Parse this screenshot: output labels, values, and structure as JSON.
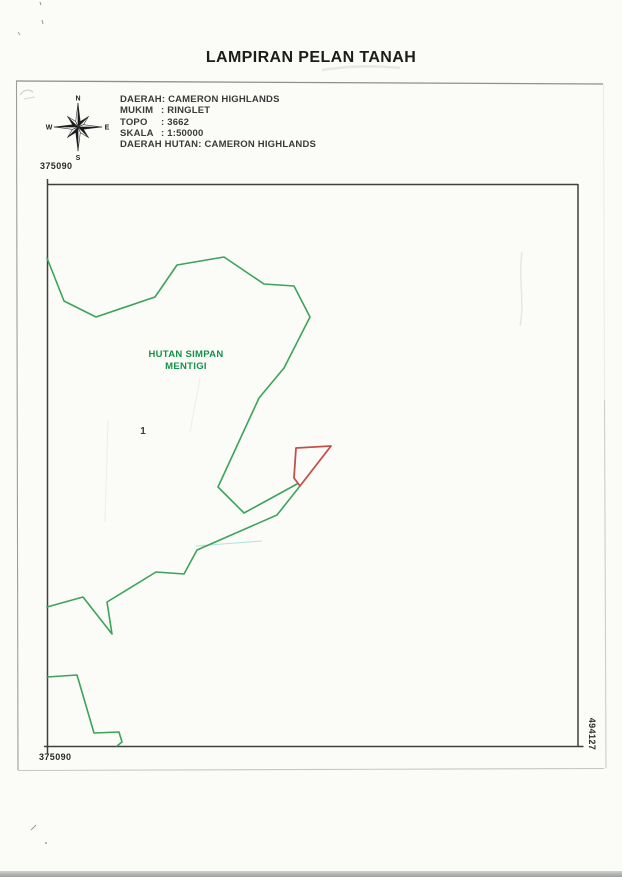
{
  "page": {
    "title": "LAMPIRAN PELAN TANAH"
  },
  "legend": {
    "separator": ":",
    "rows": [
      {
        "label": "DAERAH",
        "value": "CAMERON HIGHLANDS"
      },
      {
        "label": "MUKIM",
        "value": "RINGLET"
      },
      {
        "label": "TOPO",
        "value": "3662"
      },
      {
        "label": "SKALA",
        "value": "1:50000"
      },
      {
        "label": "DAERAH HUTAN",
        "value": "CAMERON HIGHLANDS"
      }
    ]
  },
  "compass": {
    "north": "N",
    "east": "E",
    "south": "S",
    "west": "W"
  },
  "map": {
    "coordinates": {
      "top_left": "375090",
      "bottom_left": "375090",
      "right_bottom": "494127"
    },
    "labels": [
      {
        "name": "forest-reserve-label",
        "lines": [
          "HUTAN SIMPAN",
          "MENTIGI"
        ]
      },
      {
        "name": "parcel-number-label",
        "lines": [
          "1"
        ]
      }
    ],
    "colors": {
      "boundary_green": "#3da35c",
      "lot_red": "#c1514b",
      "forest_text_green": "#17904a",
      "frame_gray": "#3e3e3e"
    },
    "features": [
      {
        "name": "forest-boundary-upper",
        "type": "polyline",
        "stroke": "#3da35c",
        "width": 1.6,
        "points": [
          [
            47,
            258
          ],
          [
            64,
            301
          ],
          [
            96,
            317
          ],
          [
            155,
            297
          ],
          [
            177,
            265
          ],
          [
            224,
            257
          ],
          [
            264,
            284
          ],
          [
            294,
            286
          ],
          [
            310,
            317
          ],
          [
            284,
            368
          ],
          [
            259,
            398
          ],
          [
            218,
            487
          ],
          [
            244,
            513
          ],
          [
            297,
            484
          ]
        ]
      },
      {
        "name": "forest-boundary-lower",
        "type": "polyline",
        "stroke": "#3da35c",
        "width": 1.6,
        "points": [
          [
            300,
            486
          ],
          [
            277,
            515
          ],
          [
            197,
            550
          ],
          [
            184,
            574
          ],
          [
            156,
            572
          ],
          [
            107,
            602
          ],
          [
            112,
            634
          ],
          [
            83,
            597
          ],
          [
            47,
            607
          ]
        ]
      },
      {
        "name": "forest-boundary-southwest",
        "type": "polyline",
        "stroke": "#3da35c",
        "width": 1.6,
        "points": [
          [
            47,
            677
          ],
          [
            77,
            675
          ],
          [
            94,
            733
          ],
          [
            119,
            732
          ],
          [
            122,
            742
          ],
          [
            117,
            746
          ]
        ]
      },
      {
        "name": "subject-lot-boundary",
        "type": "polygon",
        "stroke": "#c1514b",
        "width": 1.8,
        "points": [
          [
            296,
            448
          ],
          [
            331,
            446
          ],
          [
            300,
            486
          ],
          [
            294,
            478
          ]
        ]
      }
    ]
  }
}
